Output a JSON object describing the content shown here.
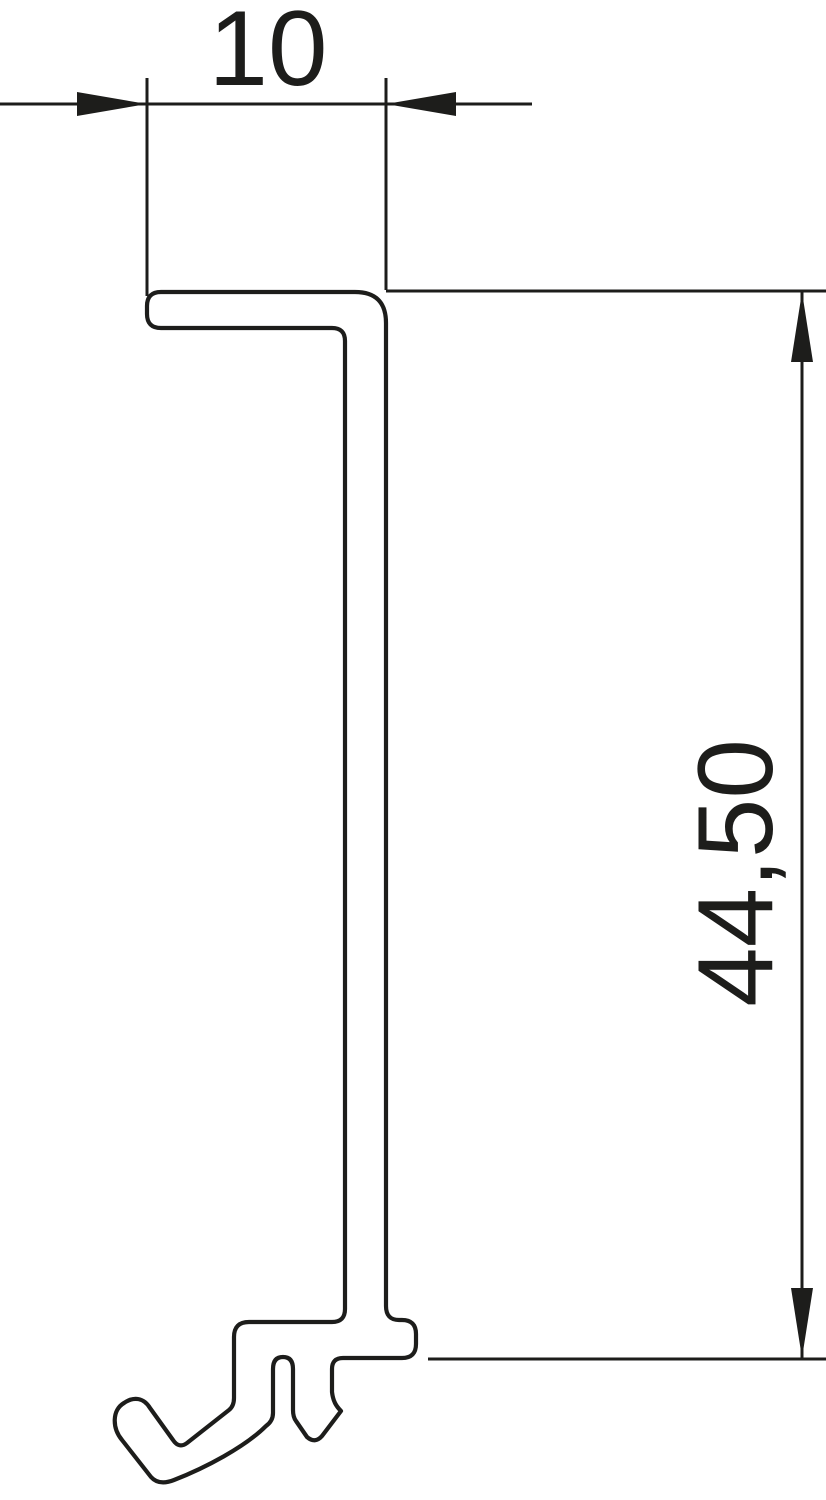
{
  "page": {
    "background_color": "#ffffff",
    "canvas": {
      "width": 826,
      "height": 1500
    }
  },
  "drawing": {
    "kind": "technical-drawing-profile-cross-section",
    "description": "Cross-section of a partition profile: top flange, long vertical web, hooked foot with barb tabs",
    "line_color": "#1d1d1b",
    "profile": {
      "path_d": "M 161,292 L 355,292 Q 386,292 386,323 L 386,1306 Q 386,1320 399,1320 L 402,1320 Q 416,1320 416,1334 L 416,1344 Q 416,1358 402,1358 L 343,1358 Q 332,1358 332,1369 L 332,1392 C 333,1401 336,1406 341,1411 L 322,1436 Q 315,1444 307,1437 L 296,1421 Q 293,1417 293,1410 L 293,1369 Q 293,1357 283,1357 Q 273,1357 273,1369 L 273,1413 Q 273,1421 266,1426 C 245,1447 205,1468 174,1480 Q 159,1486 151,1477 L 122,1440 C 112,1428 112,1410 124,1403 C 134,1396 144,1398 150,1408 L 173,1440 Q 179,1449 187,1443 L 229,1410 Q 234,1406 234,1398 L 234,1337 Q 234,1322 249,1322 L 332,1322 Q 345,1322 345,1309 L 345,341 Q 345,328 332,328 L 161,328 Q 147,328 147,314 L 147,306 Q 147,292 161,292 Z"
    },
    "dimensions": [
      {
        "label": "10",
        "orientation": "horizontal",
        "dim_line_d": "M 0,104 H 532",
        "ext_lines_d": [
          "M 147,78 V 296",
          "M 386,78 V 290"
        ],
        "arrow_points": [
          "147,104 77,92 77,116",
          "386,104 456,92 456,116"
        ],
        "label_x": 268,
        "label_y": 85
      },
      {
        "label": "44,50",
        "orientation": "vertical",
        "dim_line_d": "M 802,292 V 1358",
        "ext_lines_d": [
          "M 386,291 H 826",
          "M 428,1359 H 826"
        ],
        "arrow_points": [
          "802,292 791,362 813,362",
          "802,1358 791,1288 813,1288"
        ],
        "label_x": 772,
        "label_y": 873
      }
    ]
  }
}
